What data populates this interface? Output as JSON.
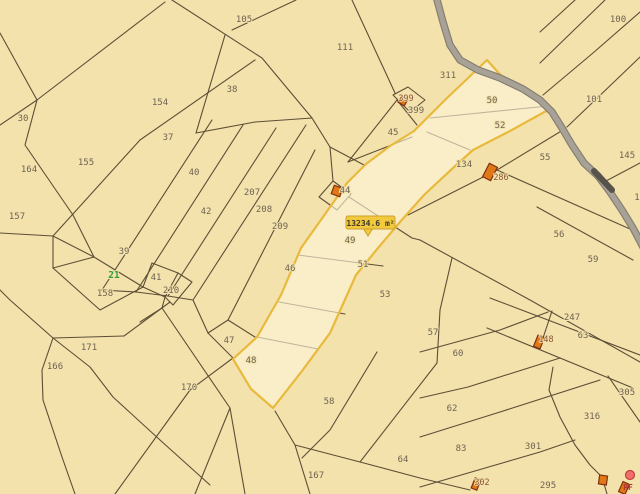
{
  "app": {
    "name": "cadastral-map-viewer"
  },
  "colors": {
    "background": "#f3e2ac",
    "boundary_line": "#5d4e37",
    "selected_outline": "#e8b93c",
    "selected_fill": "#fdf6da",
    "road_gray": "#a8a296",
    "building_orange": "#e07818",
    "label_gray": "#6e6353",
    "label_green": "#2e9e38",
    "tooltip_yellow": "#f2c83c",
    "marker_red": "#f26d6d"
  },
  "selected_parcel": {
    "area_label": "13234.6 m²"
  },
  "parcel_labels": [
    {
      "text": "105",
      "x": 244,
      "y": 19
    },
    {
      "text": "111",
      "x": 345,
      "y": 47
    },
    {
      "text": "154",
      "x": 160,
      "y": 102
    },
    {
      "text": "38",
      "x": 232,
      "y": 89
    },
    {
      "text": "30",
      "x": 23,
      "y": 118
    },
    {
      "text": "37",
      "x": 168,
      "y": 137
    },
    {
      "text": "155",
      "x": 86,
      "y": 162
    },
    {
      "text": "164",
      "x": 29,
      "y": 169
    },
    {
      "text": "40",
      "x": 194,
      "y": 172
    },
    {
      "text": "157",
      "x": 17,
      "y": 216
    },
    {
      "text": "42",
      "x": 206,
      "y": 211
    },
    {
      "text": "207",
      "x": 252,
      "y": 192
    },
    {
      "text": "208",
      "x": 264,
      "y": 209
    },
    {
      "text": "209",
      "x": 280,
      "y": 226
    },
    {
      "text": "39",
      "x": 124,
      "y": 251
    },
    {
      "text": "21",
      "x": 114,
      "y": 275,
      "color": "green"
    },
    {
      "text": "41",
      "x": 156,
      "y": 277
    },
    {
      "text": "210",
      "x": 171,
      "y": 290
    },
    {
      "text": "158",
      "x": 105,
      "y": 293
    },
    {
      "text": "46",
      "x": 290,
      "y": 268
    },
    {
      "text": "45",
      "x": 393,
      "y": 132
    },
    {
      "text": "399",
      "x": 416,
      "y": 110
    },
    {
      "text": "311",
      "x": 448,
      "y": 75
    },
    {
      "text": "50",
      "x": 492,
      "y": 100
    },
    {
      "text": "52",
      "x": 500,
      "y": 125
    },
    {
      "text": "100",
      "x": 618,
      "y": 19
    },
    {
      "text": "101",
      "x": 594,
      "y": 99
    },
    {
      "text": "134",
      "x": 464,
      "y": 164
    },
    {
      "text": "55",
      "x": 545,
      "y": 157
    },
    {
      "text": "145",
      "x": 627,
      "y": 155
    },
    {
      "text": "1",
      "x": 637,
      "y": 197
    },
    {
      "text": "56",
      "x": 559,
      "y": 234
    },
    {
      "text": "44",
      "x": 345,
      "y": 190
    },
    {
      "text": "49",
      "x": 350,
      "y": 240
    },
    {
      "text": "51",
      "x": 363,
      "y": 264
    },
    {
      "text": "53",
      "x": 385,
      "y": 294
    },
    {
      "text": "59",
      "x": 593,
      "y": 259
    },
    {
      "text": "247",
      "x": 572,
      "y": 317
    },
    {
      "text": "57",
      "x": 433,
      "y": 332
    },
    {
      "text": "63",
      "x": 583,
      "y": 335
    },
    {
      "text": "60",
      "x": 458,
      "y": 353
    },
    {
      "text": "305",
      "x": 627,
      "y": 392
    },
    {
      "text": "62",
      "x": 452,
      "y": 408
    },
    {
      "text": "316",
      "x": 592,
      "y": 416
    },
    {
      "text": "83",
      "x": 461,
      "y": 448
    },
    {
      "text": "301",
      "x": 533,
      "y": 446
    },
    {
      "text": "64",
      "x": 403,
      "y": 459
    },
    {
      "text": "47",
      "x": 229,
      "y": 340
    },
    {
      "text": "48",
      "x": 251,
      "y": 360
    },
    {
      "text": "170",
      "x": 189,
      "y": 387
    },
    {
      "text": "171",
      "x": 89,
      "y": 347
    },
    {
      "text": "166",
      "x": 55,
      "y": 366
    },
    {
      "text": "167",
      "x": 316,
      "y": 475
    },
    {
      "text": "58",
      "x": 329,
      "y": 401
    },
    {
      "text": "295",
      "x": 548,
      "y": 485
    }
  ],
  "building_labels": [
    {
      "text": "399",
      "x": 406,
      "y": 98
    },
    {
      "text": "286",
      "x": 501,
      "y": 177
    },
    {
      "text": "148",
      "x": 546,
      "y": 339
    },
    {
      "text": "302",
      "x": 482,
      "y": 482
    }
  ],
  "buildings": [
    {
      "x": 337,
      "y": 191,
      "w": 9,
      "h": 9,
      "r": 20
    },
    {
      "x": 403,
      "y": 101,
      "w": 7,
      "h": 7,
      "r": 30
    },
    {
      "x": 490,
      "y": 172,
      "w": 9,
      "h": 15,
      "r": 27
    },
    {
      "x": 539,
      "y": 342,
      "w": 7,
      "h": 12,
      "r": 22
    },
    {
      "x": 476,
      "y": 484,
      "w": 6,
      "h": 11,
      "r": 22
    },
    {
      "x": 603,
      "y": 480,
      "w": 8,
      "h": 9,
      "r": 8
    },
    {
      "x": 624,
      "y": 488,
      "w": 7,
      "h": 11,
      "r": 24
    }
  ],
  "marker": {
    "label": "PF",
    "x": 630,
    "y": 475,
    "label_x": 628,
    "label_y": 487
  }
}
